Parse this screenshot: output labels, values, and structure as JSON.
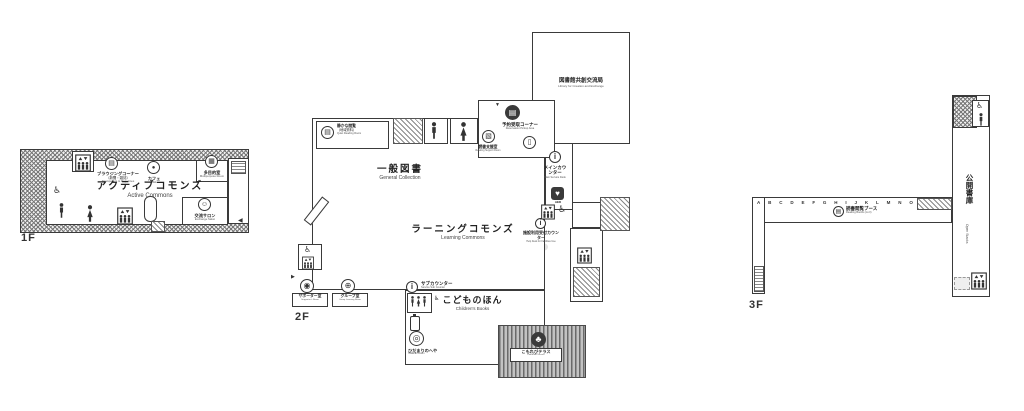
{
  "icons": {
    "wheelchair": "♿",
    "heart": "♥",
    "tree": "♣",
    "info": "i",
    "down_arrow": "▼",
    "left_arrow": "◀",
    "right_arrow": "▶",
    "book": "▤",
    "grid": "▦",
    "cup": "●",
    "smile": "☺",
    "gate": "▯",
    "support": "▧",
    "disc": "◉",
    "group": "⊕",
    "target": "◎"
  },
  "floors": {
    "f1": {
      "label": "1F",
      "rooms": {
        "browsing": {
          "ja": "ブラウジングコーナー",
          "note": "（新聞・雑誌）",
          "en": "Newspapers & Magazines"
        },
        "cafe": {
          "ja": "カフェ",
          "en": "Cafe"
        },
        "multipurpose": {
          "ja": "多目的室",
          "en": "Multipurpose Room"
        },
        "active_commons": {
          "ja": "アクティブコモンズ",
          "en": "Active Commons"
        },
        "salon": {
          "ja": "交流サロン",
          "en": "Exchange Salon"
        }
      }
    },
    "f2": {
      "label": "2F",
      "rooms": {
        "quiet_reading": {
          "ja": "静かな閲覧",
          "note": "（地域資料）",
          "en": "Quiet Reading Room"
        },
        "bureau": {
          "ja": "図書館共創交流局",
          "en": "Library for Creation and Exchange"
        },
        "reservation": {
          "ja": "予約受取コーナー",
          "en": "Reservation Pickup Area"
        },
        "reading_support": {
          "ja": "読書支援室",
          "en": "Reading Support Room"
        },
        "general": {
          "ja": "一般図書",
          "en": "General Collection"
        },
        "main_counter": {
          "ja": "メインカウンター",
          "en": "Main Service Desk"
        },
        "aed": "AED",
        "learning": {
          "ja": "ラーニングコモンズ",
          "en": "Learning Commons"
        },
        "facility": {
          "ja": "施設利用受付カウンター",
          "en": "Help Desk for Facilities Use"
        },
        "sub_counter": {
          "ja": "サブカウンター",
          "en": "Service Sub Counter"
        },
        "supporter": {
          "ja": "サポーター室",
          "en": "Supporter's Room"
        },
        "group": {
          "ja": "グループ室",
          "en": "Group Learning Room"
        },
        "children": {
          "ja": "こどものほん",
          "en": "Children's Books"
        },
        "hidamari": {
          "ja": "ひだまりのへや",
          "en": "Hidamari Room"
        },
        "terrace": {
          "ja": "こもれびテラス",
          "en": "Komorebi Terrace"
        }
      }
    },
    "f3": {
      "label": "3F",
      "rooms": {
        "open_stacks": {
          "ja": "公開書庫",
          "en": "Open Stacks"
        },
        "reading_booths": {
          "ja": "読書閲覧ブース",
          "en": "Reading Booths (A-O)"
        }
      },
      "booths": [
        "A",
        "B",
        "C",
        "D",
        "E",
        "F",
        "G",
        "H",
        "I",
        "J",
        "K",
        "L",
        "M",
        "N",
        "O"
      ]
    }
  }
}
